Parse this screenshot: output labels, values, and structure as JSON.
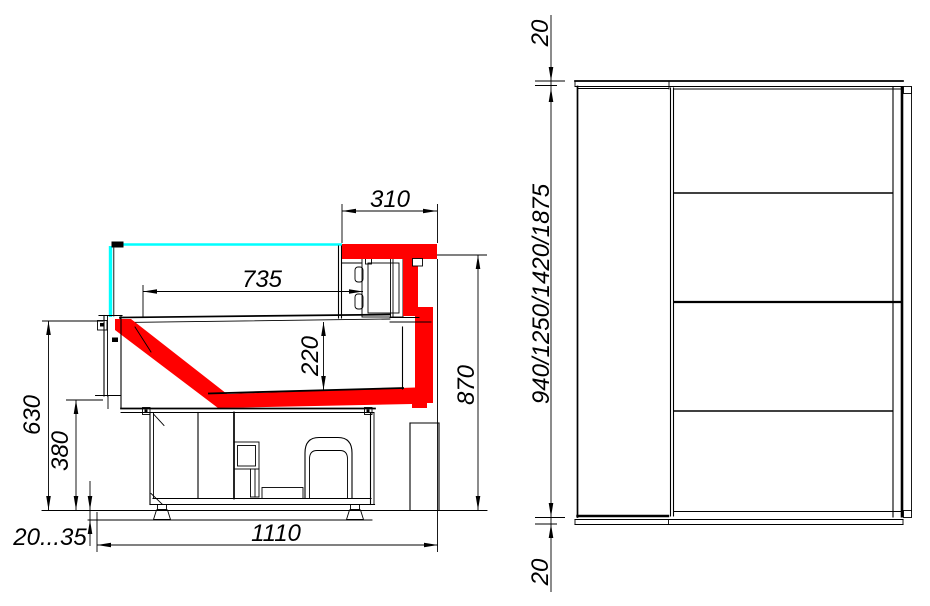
{
  "colors": {
    "highlight": "#ff0000",
    "glass": "#00ffff",
    "line": "#000000",
    "background": "#ffffff"
  },
  "section_view": {
    "dims": {
      "canopy_width": "310",
      "display_width": "735",
      "display_height": "220",
      "glass_height": "630",
      "base_height": "380",
      "work_height": "870",
      "base_length": "1110",
      "foot_range": "20...35"
    }
  },
  "front_view": {
    "dims": {
      "top_panel": "20",
      "overall_heights": "940/1250/1420/1875",
      "bottom_panel": "20"
    }
  }
}
